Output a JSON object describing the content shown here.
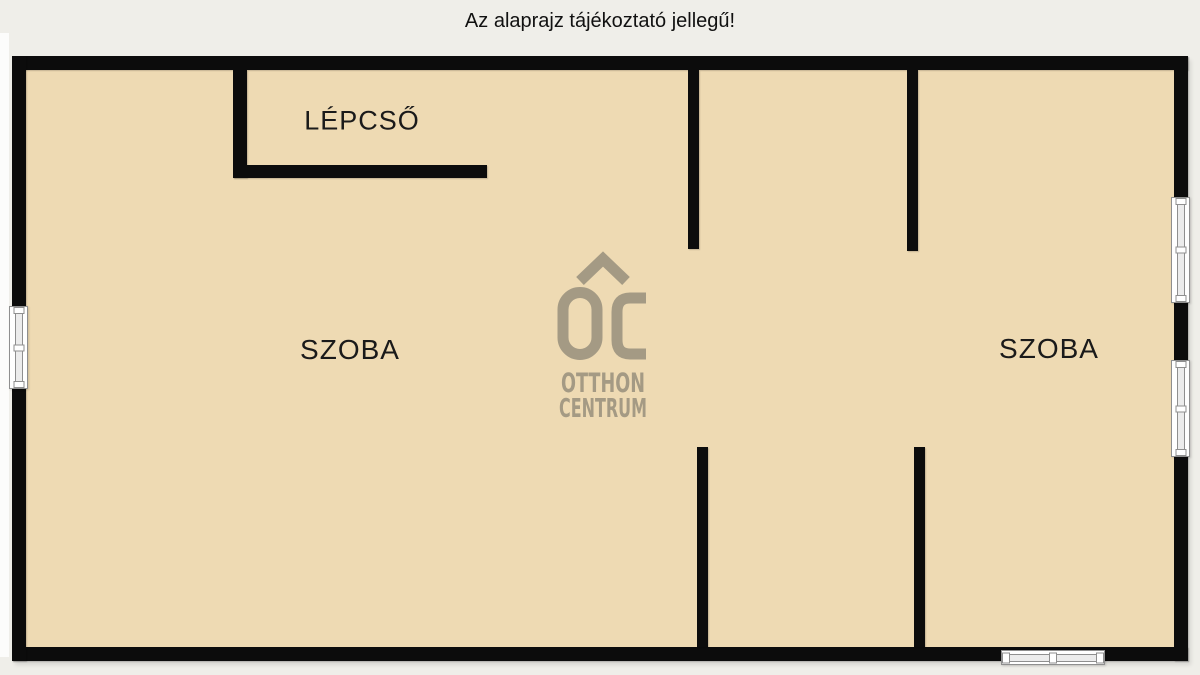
{
  "title": {
    "text": "Az alaprajz tájékoztató jellegű!"
  },
  "watermark": {
    "monogram": "OC",
    "line1": "OTTHON",
    "line2": "CENTRUM"
  },
  "colors": {
    "background": "#efeee9",
    "floor": "#eedab3",
    "wall": "#0c0c0c",
    "logo": "#a49a84",
    "window_frame": "#8f8f8f",
    "text": "#111111"
  },
  "floorplan": {
    "rooms": [
      {
        "label": "LÉPCSŐ",
        "cx": 362,
        "cy": 121,
        "font_size": 27
      },
      {
        "label": "SZOBA",
        "cx": 350,
        "cy": 350,
        "font_size": 28
      },
      {
        "label": "SZOBA",
        "cx": 1049,
        "cy": 349,
        "font_size": 28
      }
    ],
    "walls": [
      {
        "name": "wall-outer-top",
        "x": 12,
        "y": 56,
        "w": 1176,
        "h": 14
      },
      {
        "name": "wall-outer-bottom",
        "x": 12,
        "y": 647,
        "w": 1176,
        "h": 14
      },
      {
        "name": "wall-outer-left",
        "x": 12,
        "y": 56,
        "w": 14,
        "h": 605
      },
      {
        "name": "wall-outer-right",
        "x": 1174,
        "y": 56,
        "w": 14,
        "h": 605
      },
      {
        "name": "wall-stair-vertical",
        "x": 233,
        "y": 70,
        "w": 14,
        "h": 108
      },
      {
        "name": "wall-stair-horizontal",
        "x": 233,
        "y": 165,
        "w": 254,
        "h": 13
      },
      {
        "name": "wall-upper-middle",
        "x": 688,
        "y": 70,
        "w": 11,
        "h": 179
      },
      {
        "name": "wall-upper-right",
        "x": 907,
        "y": 70,
        "w": 11,
        "h": 181
      },
      {
        "name": "wall-lower-middle",
        "x": 697,
        "y": 447,
        "w": 11,
        "h": 200
      },
      {
        "name": "wall-lower-right",
        "x": 914,
        "y": 447,
        "w": 11,
        "h": 200
      }
    ],
    "windows": [
      {
        "name": "window-left",
        "x": 9,
        "y": 306,
        "w": 19,
        "h": 83,
        "orientation": "vertical"
      },
      {
        "name": "window-right-upper",
        "x": 1171,
        "y": 197,
        "w": 19,
        "h": 106,
        "orientation": "vertical"
      },
      {
        "name": "window-right-lower",
        "x": 1171,
        "y": 360,
        "w": 19,
        "h": 97,
        "orientation": "vertical"
      },
      {
        "name": "window-bottom",
        "x": 1001,
        "y": 650,
        "w": 104,
        "h": 15,
        "orientation": "horizontal"
      }
    ]
  }
}
